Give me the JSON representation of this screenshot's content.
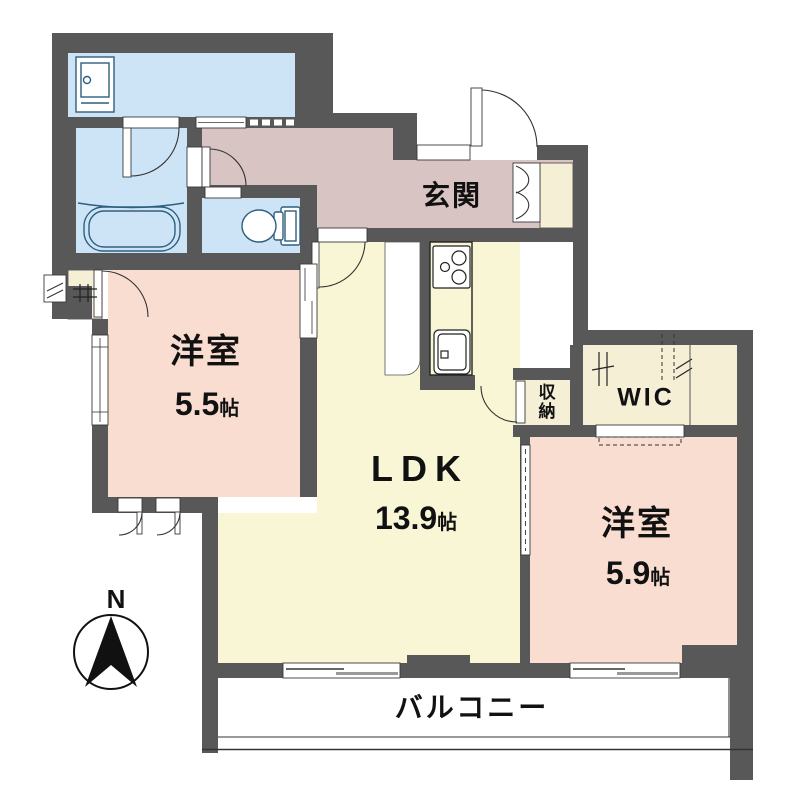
{
  "floorplan": {
    "compass": {
      "label": "N"
    },
    "rooms": {
      "entrance": {
        "label": "玄関"
      },
      "ldk": {
        "label": "LDK",
        "size": "13.9",
        "unit": "帖"
      },
      "bedroom_west": {
        "label": "洋室",
        "size": "5.5",
        "unit": "帖"
      },
      "bedroom_east": {
        "label": "洋室",
        "size": "5.9",
        "unit": "帖"
      },
      "storage": {
        "label": "収納"
      },
      "walk_in_closet": {
        "label": "WIC"
      },
      "balcony": {
        "label": "バルコニー"
      }
    },
    "colors": {
      "wall": "#585858",
      "water": "#cde4f6",
      "hall": "#d9c4c4",
      "ldk": "#f8f6d5",
      "closet": "#f5efd6",
      "bedroom": "#f9ddd1",
      "fixline": "#2e5f7e"
    }
  }
}
